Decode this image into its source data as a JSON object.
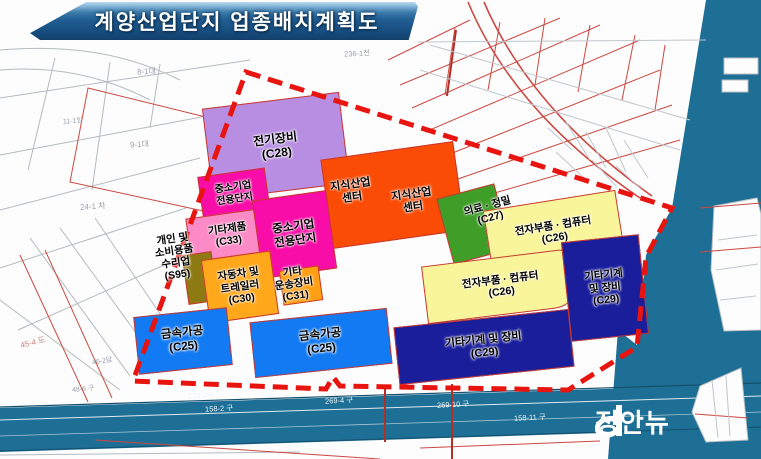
{
  "title": "계양산업단지 업종배치계획도",
  "watermark": "정안뉴",
  "zones": [
    {
      "id": "c28",
      "label": "전기장비\n(C28)",
      "industry": "전기장비",
      "code": "C28",
      "color": "#b78ee2"
    },
    {
      "id": "knowledge-center",
      "labels": [
        "지식산업\n센터",
        "지식산업\n센터"
      ],
      "industry": "지식산업센터",
      "color": "#fa4c05"
    },
    {
      "id": "sme-small",
      "label": "중소기업\n전용단지",
      "industry": "중소기업 전용단지",
      "color": "#f90da8"
    },
    {
      "id": "c33",
      "label": "기타제품\n(C33)",
      "industry": "기타제품",
      "code": "C33",
      "color": "#fb8ac6"
    },
    {
      "id": "sme-big",
      "label": "중소기업\n전용단지",
      "industry": "중소기업 전용단지",
      "color": "#f90da8"
    },
    {
      "id": "s95",
      "label": "개인 및\n소비용품\n수리업\n(S95)",
      "industry": "개인 및 소비용품 수리업",
      "code": "S95",
      "color": "#8d7a12"
    },
    {
      "id": "c30",
      "label": "자동차 및\n트레일러\n(C30)",
      "industry": "자동차 및 트레일러",
      "code": "C30",
      "color": "#ffa81c"
    },
    {
      "id": "c31",
      "label": "기타\n운송장비\n(C31)",
      "industry": "기타 운송장비",
      "code": "C31",
      "color": "#ffa014"
    },
    {
      "id": "c27",
      "label": "의료 · 정밀\n(C27)",
      "industry": "의료·정밀",
      "code": "C27",
      "color": "#3f9e28"
    },
    {
      "id": "c26-upper",
      "label": "전자부품 · 컴퓨터\n(C26)",
      "industry": "전자부품·컴퓨터",
      "code": "C26",
      "color": "#f9f59b"
    },
    {
      "id": "c26-lower",
      "label": "전자부품 · 컴퓨터\n(C26)",
      "industry": "전자부품·컴퓨터",
      "code": "C26",
      "color": "#f9f59b"
    },
    {
      "id": "c29-right",
      "label": "기타기계\n및 장비\n(C29)",
      "industry": "기타기계 및 장비",
      "code": "C29",
      "color": "#1a1e9b"
    },
    {
      "id": "c29-bottom",
      "label": "기타기계 및 장비\n(C29)",
      "industry": "기타기계 및 장비",
      "code": "C29",
      "color": "#1a1e9b"
    },
    {
      "id": "c25-left",
      "label": "금속가공\n(C25)",
      "industry": "금속가공",
      "code": "C25",
      "color": "#127af2"
    },
    {
      "id": "c25-right",
      "label": "금속가공\n(C25)",
      "industry": "금속가공",
      "code": "C25",
      "color": "#127af2"
    }
  ],
  "parcels": [
    "8-1대",
    "9-1대",
    "11-1임",
    "24-1 차",
    "45-4 도",
    "46-2답",
    "236-1전",
    "48-6 구"
  ],
  "roads": [
    "279-1구",
    "158-2 구",
    "269-4 구",
    "269-10 구",
    "158-11 구"
  ],
  "colors": {
    "banner": "#1c5990",
    "water": "#1e6f95",
    "boundary": "#e81410",
    "cadastral_gray": "#b4bac0",
    "cadastral_red": "#cc4840"
  }
}
